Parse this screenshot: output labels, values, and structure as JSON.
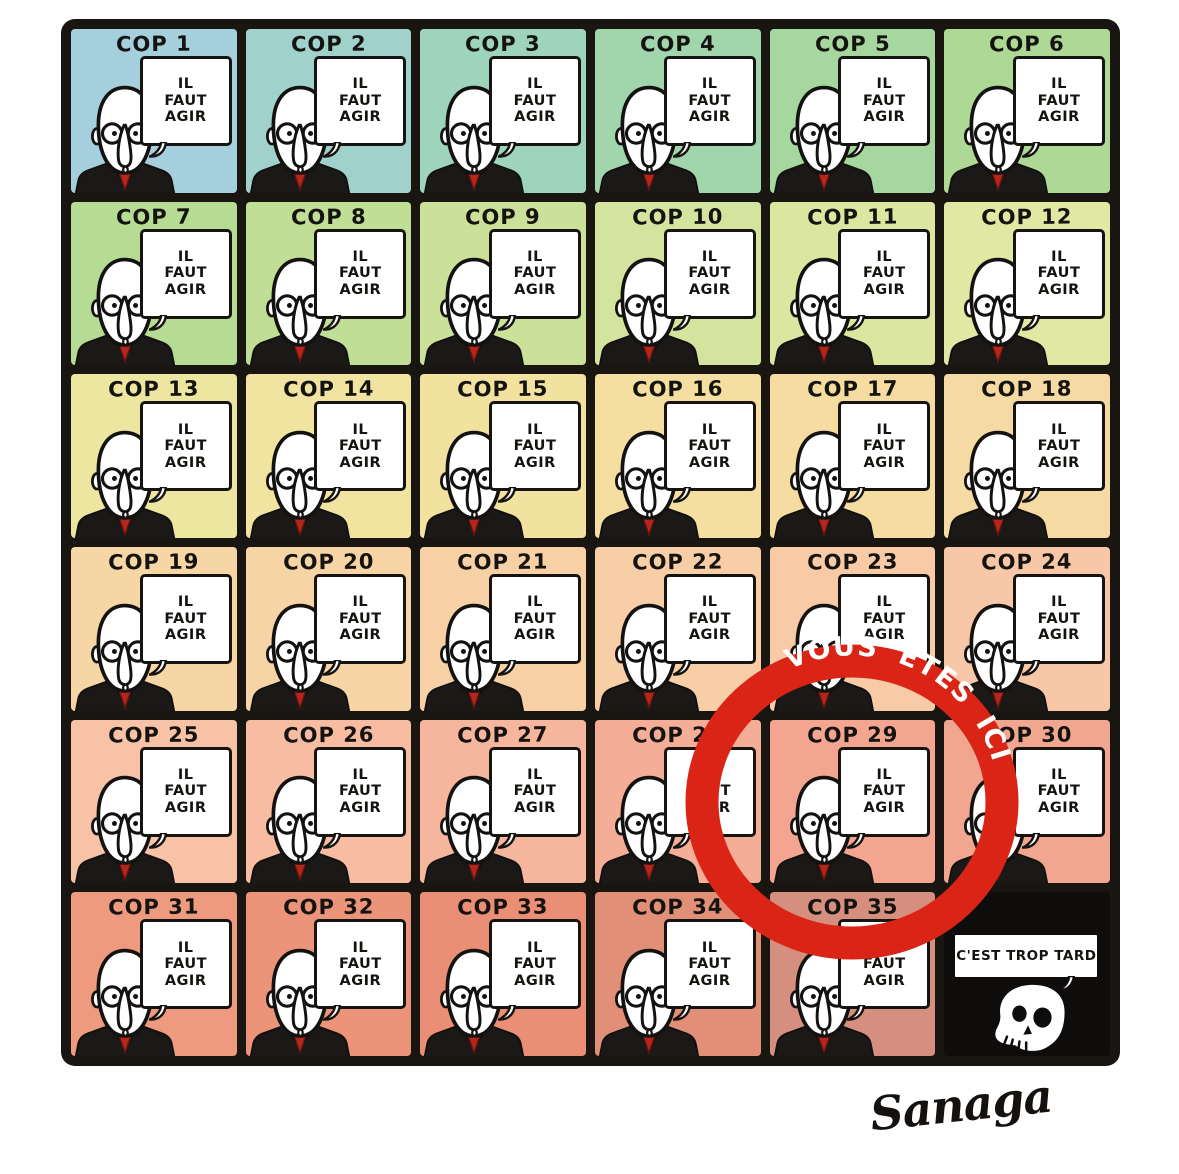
{
  "grid": {
    "rows": 6,
    "cols": 6,
    "cells": [
      {
        "label": "COP 1",
        "bg": "#a6cfdd"
      },
      {
        "label": "COP 2",
        "bg": "#a0d2cb"
      },
      {
        "label": "COP 3",
        "bg": "#9ed4bb"
      },
      {
        "label": "COP 4",
        "bg": "#a1d6ad"
      },
      {
        "label": "COP 5",
        "bg": "#a5d79e"
      },
      {
        "label": "COP 6",
        "bg": "#add994"
      },
      {
        "label": "COP 7",
        "bg": "#b6db92"
      },
      {
        "label": "COP 8",
        "bg": "#c0de96"
      },
      {
        "label": "COP 9",
        "bg": "#cbe19a"
      },
      {
        "label": "COP 10",
        "bg": "#d4e49e"
      },
      {
        "label": "COP 11",
        "bg": "#dbe6a1"
      },
      {
        "label": "COP 12",
        "bg": "#e0e8a4"
      },
      {
        "label": "COP 13",
        "bg": "#ede6a0"
      },
      {
        "label": "COP 14",
        "bg": "#f0e4a0"
      },
      {
        "label": "COP 15",
        "bg": "#f2e2a0"
      },
      {
        "label": "COP 16",
        "bg": "#f4dfa1"
      },
      {
        "label": "COP 17",
        "bg": "#f5dda2"
      },
      {
        "label": "COP 18",
        "bg": "#f6daa3"
      },
      {
        "label": "COP 19",
        "bg": "#f6d6a4"
      },
      {
        "label": "COP 20",
        "bg": "#f7d4a5"
      },
      {
        "label": "COP 21",
        "bg": "#f7d1a5"
      },
      {
        "label": "COP 22",
        "bg": "#f8cea6"
      },
      {
        "label": "COP 23",
        "bg": "#f8caa6"
      },
      {
        "label": "COP 24",
        "bg": "#f8c7a7"
      },
      {
        "label": "COP 25",
        "bg": "#f8c2a6"
      },
      {
        "label": "COP 26",
        "bg": "#f7bca2"
      },
      {
        "label": "COP 27",
        "bg": "#f6b59d"
      },
      {
        "label": "COP 28",
        "bg": "#f4ad96"
      },
      {
        "label": "COP 29",
        "bg": "#f3a590"
      },
      {
        "label": "COP 30",
        "bg": "#f1a78f"
      },
      {
        "label": "COP 31",
        "bg": "#ee9a7e"
      },
      {
        "label": "COP 32",
        "bg": "#ec9479"
      },
      {
        "label": "COP 33",
        "bg": "#ea8f75"
      },
      {
        "label": "COP 34",
        "bg": "#e28f77"
      },
      {
        "label": "COP 35",
        "bg": "#d48f7e"
      }
    ],
    "last_cell": {
      "bg": "#0f0d0c",
      "speech": "C'EST TROP TARD",
      "icon": "skull-icon"
    }
  },
  "speech": {
    "lines": [
      "IL",
      "FAUT",
      "AGIR"
    ]
  },
  "marker": {
    "text": "VOUS ÊTES ICI",
    "color": "#da2415",
    "target": "COP 29"
  },
  "signature": "Sanaga",
  "colors": {
    "ink": "#161310",
    "tie_red": "#b5271c",
    "ring_red": "#da2415"
  }
}
